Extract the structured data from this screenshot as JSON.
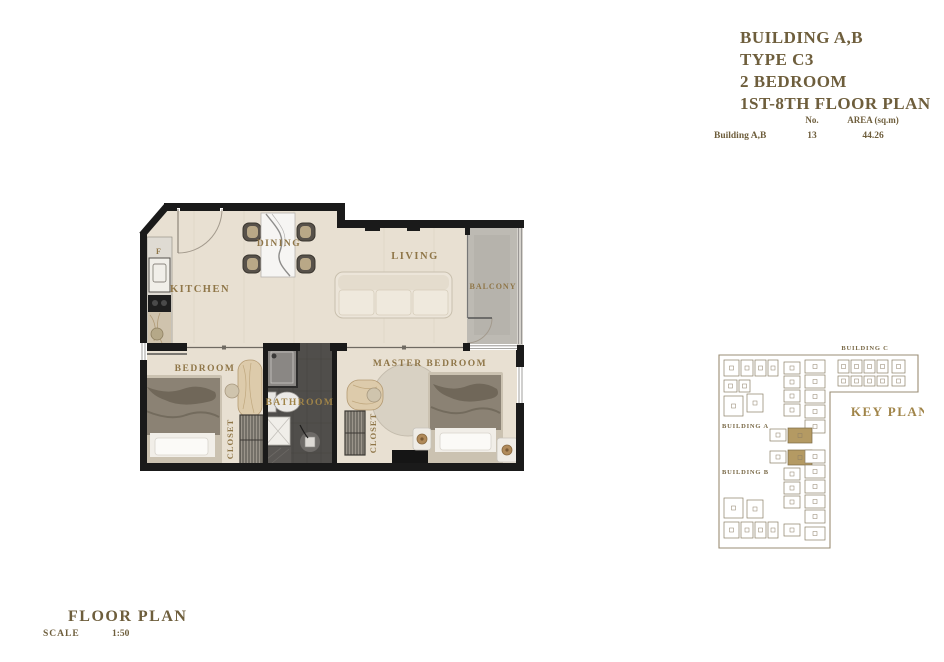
{
  "title_block": {
    "lines": [
      "BUILDING A,B",
      "TYPE C3",
      "2 BEDROOM",
      "1ST-8TH FLOOR PLAN"
    ]
  },
  "spec_table": {
    "headers": {
      "no": "No.",
      "area": "AREA (sq.m)"
    },
    "row": {
      "name": "Building A,B",
      "no": "13",
      "area": "44.26"
    }
  },
  "floor_plan": {
    "labels": {
      "kitchen": "KITCHEN",
      "dining": "DINING",
      "living": "LIVING",
      "balcony": "BALCONY",
      "bedroom": "BEDROOM",
      "master_bedroom": "MASTER BEDROOM",
      "bathroom": "BATHROOM",
      "closet_bedroom": "CLOSET",
      "closet_master": "CLOSET",
      "fridge": "F"
    }
  },
  "key_plan": {
    "title": "KEY PLAN",
    "building_a": "BUILDING A",
    "building_b": "BUILDING B",
    "building_c": "BUILDING C"
  },
  "footer": {
    "title": "FLOOR PLAN",
    "scale_label": "SCALE",
    "scale_value": "1:50"
  },
  "colors": {
    "title_text": "#6e5e3c",
    "label_gold": "#8f7648",
    "key_plan_gold": "#a08448",
    "highlight_unit": "#b49a63",
    "wall_black": "#1a1a1a",
    "floor_beige": "#e8e0d2",
    "balcony_gray": "#bdbab3",
    "bathroom_dark": "#504e4b"
  }
}
